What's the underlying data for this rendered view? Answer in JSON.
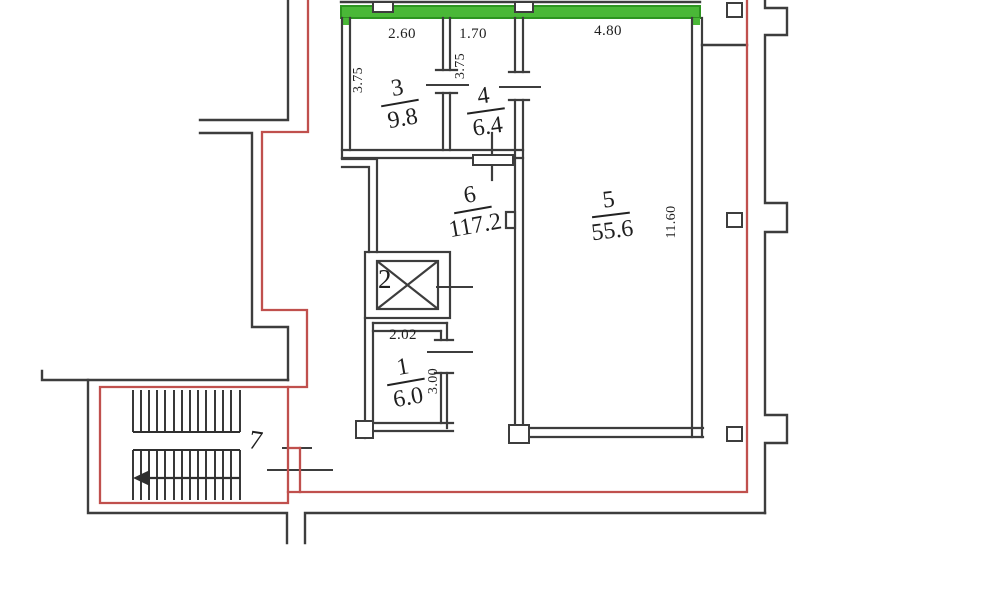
{
  "plan_type": "floor-plan",
  "colors": {
    "wall": "#3d3d3d",
    "boundary_red": "#c0504d",
    "highlight_green": "#4ab837",
    "highlight_green_edge": "#2d9420"
  },
  "rooms": {
    "r3": {
      "number": "3",
      "area": "9.8"
    },
    "r4": {
      "number": "4",
      "area": "6.4"
    },
    "r6": {
      "number": "6",
      "area": "117.2"
    },
    "r5": {
      "number": "5",
      "area": "55.6"
    },
    "r1": {
      "number": "1",
      "area": "6.0"
    },
    "r2": {
      "number": "2"
    },
    "r7": {
      "number": "7"
    }
  },
  "dimensions": {
    "room3_width": "2.60",
    "room3_depth": "3.75",
    "room4_width": "1.70",
    "room4_depth": "3.75",
    "room5_width": "4.80",
    "room5_depth": "11.60",
    "room1_width": "2.02",
    "room1_depth": "3.00"
  }
}
